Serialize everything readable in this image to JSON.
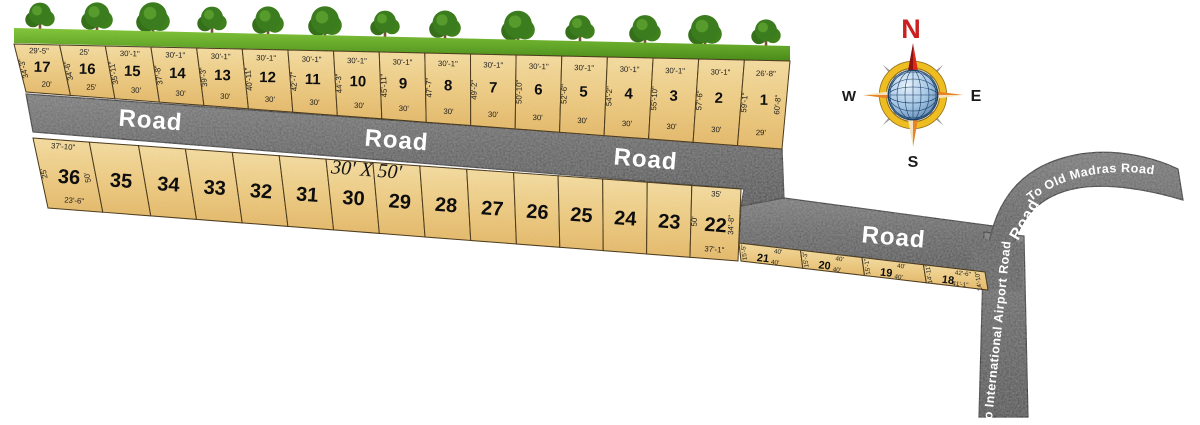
{
  "title": "Residential plot layout site plan",
  "roads": {
    "top_labels": [
      "Road",
      "Road",
      "Road"
    ],
    "middle_label": "Road",
    "curve_label": "Road",
    "old_madras": "To Old Madras Road",
    "airport": "To International Airport Road"
  },
  "size_note": "30' X 50'",
  "compass": {
    "north": "N",
    "east": "E",
    "south": "S",
    "west": "W"
  },
  "rows": {
    "top": {
      "plots": [
        {
          "no": "17",
          "top": "29'-5\"",
          "bottom": "20'",
          "left": "34'-3\""
        },
        {
          "no": "16",
          "top": "25'",
          "bottom": "25'",
          "left": "34'-6\""
        },
        {
          "no": "15",
          "top": "30'-1\"",
          "bottom": "30'",
          "left": "35'-11\""
        },
        {
          "no": "14",
          "top": "30'-1\"",
          "bottom": "30'",
          "left": "37'-8\""
        },
        {
          "no": "13",
          "top": "30'-1\"",
          "bottom": "30'",
          "left": "39'-3\""
        },
        {
          "no": "12",
          "top": "30'-1\"",
          "bottom": "30'",
          "left": "40'-11\""
        },
        {
          "no": "11",
          "top": "30'-1\"",
          "bottom": "30'",
          "left": "42'-7\""
        },
        {
          "no": "10",
          "top": "30'-1\"",
          "bottom": "30'",
          "left": "44'-3\""
        },
        {
          "no": "9",
          "top": "30'-1\"",
          "bottom": "30'",
          "left": "45'-11\""
        },
        {
          "no": "8",
          "top": "30'-1\"",
          "bottom": "30'",
          "left": "47'-7\""
        },
        {
          "no": "7",
          "top": "30'-1\"",
          "bottom": "30'",
          "left": "49'-2\""
        },
        {
          "no": "6",
          "top": "30'-1\"",
          "bottom": "30'",
          "left": "50'-10\""
        },
        {
          "no": "5",
          "top": "30'-1\"",
          "bottom": "30'",
          "left": "52'-6\""
        },
        {
          "no": "4",
          "top": "30'-1\"",
          "bottom": "30'",
          "left": "54'-2\""
        },
        {
          "no": "3",
          "top": "30'-1\"",
          "bottom": "30'",
          "left": "55'-10\""
        },
        {
          "no": "2",
          "top": "30'-1\"",
          "bottom": "30'",
          "left": "57'-6\""
        },
        {
          "no": "1",
          "top": "26'-8\"",
          "bottom": "29'",
          "left": "59'-1\"",
          "right": "60'-8\""
        }
      ]
    },
    "middle": {
      "plots": [
        {
          "no": "36",
          "top": "37'-10\"",
          "bottom": "23'-6\"",
          "left": "25'",
          "right": "50'"
        },
        {
          "no": "35"
        },
        {
          "no": "34"
        },
        {
          "no": "33"
        },
        {
          "no": "32"
        },
        {
          "no": "31"
        },
        {
          "no": "30"
        },
        {
          "no": "29"
        },
        {
          "no": "28"
        },
        {
          "no": "27"
        },
        {
          "no": "26"
        },
        {
          "no": "25"
        },
        {
          "no": "24"
        },
        {
          "no": "23"
        },
        {
          "no": "22",
          "top": "35'",
          "bottom": "37'-1\"",
          "left": "50'",
          "right": "34'-8\""
        }
      ]
    },
    "bottom": {
      "plots": [
        {
          "no": "21",
          "top": "40'",
          "bottom": "40'",
          "left": "15'-5\""
        },
        {
          "no": "20",
          "top": "40'",
          "bottom": "40'",
          "left": "15'-3\""
        },
        {
          "no": "19",
          "top": "40'",
          "bottom": "40'",
          "left": "15'-1\""
        },
        {
          "no": "18",
          "top": "42'-6\"",
          "bottom": "41'-1\"",
          "left": "14'-11\"",
          "right": "14'-10\""
        }
      ]
    }
  },
  "colors": {
    "plot_fill": "#eec87f",
    "plot_fill_light": "#f5dda3",
    "road_fill": "#5a5a5a",
    "grass_green": "#5d9e22",
    "north_red": "#cc2020",
    "pointer_orange": "#e8832a",
    "pointer_cream": "#f2e3bd",
    "globe_blue": "#5d87b5"
  }
}
